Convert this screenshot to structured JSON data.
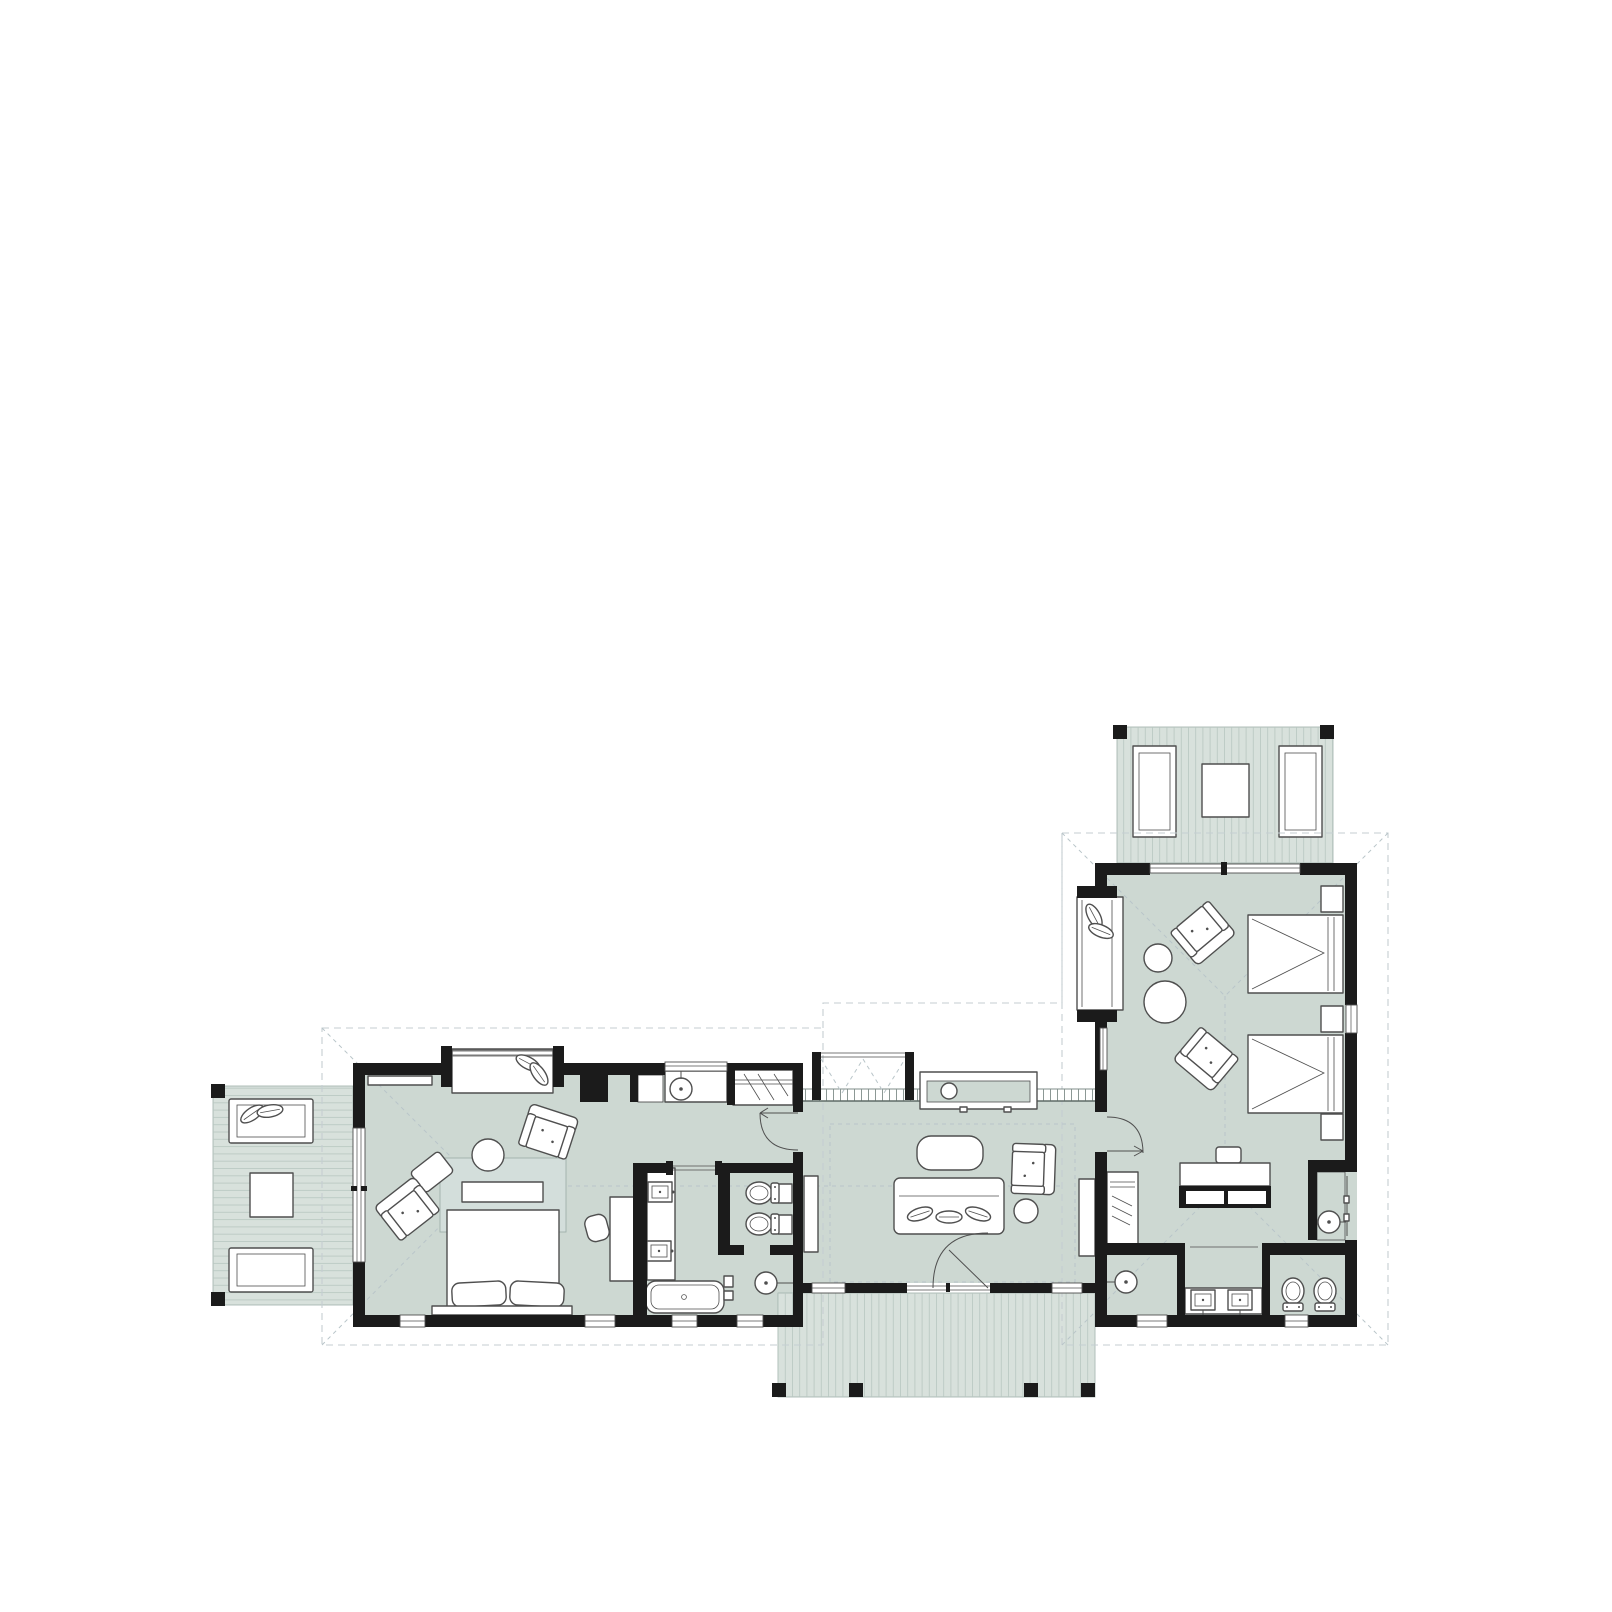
{
  "image": {
    "kind": "architectural floor plan, single-storey L-shaped house, top-down view",
    "width": 1612,
    "height": 1612,
    "background": "#ffffff",
    "visible_text": []
  },
  "palette": {
    "wall": "#1b1b1b",
    "floor": "#cdd8d2",
    "deck": "#d8e1dc",
    "deck_line": "#b7c6c0",
    "rug": "#d3dedb",
    "outline": "#4f4f4f",
    "light_line": "#9fb0aa",
    "dash": "#c5ced2",
    "dash2": "#b9c5c9",
    "rail": "#7f8d89",
    "white": "#ffffff"
  },
  "plan": {
    "decks": [
      "west-deck",
      "south-deck",
      "north-deck"
    ],
    "rooms": [
      "bedroom-west",
      "bath-corridor-west",
      "wc-room-west",
      "shower-room-west",
      "living-room",
      "bedroom-east",
      "shower-room-east",
      "vanity-room-east",
      "wc-room-east",
      "wash-room-east"
    ],
    "furniture": [
      "lounge-chair",
      "deck-table",
      "window-seat-bench",
      "wall-shelf",
      "double-bed",
      "foot-bench",
      "area-rug",
      "round-table",
      "armchair",
      "ottoman",
      "desk",
      "desk-chair",
      "sofa",
      "coffee-table",
      "side-table",
      "outdoor-counter",
      "twin-bed",
      "nightstand",
      "fireplace-unit",
      "wardrobe"
    ],
    "fixtures": [
      "round-washbasin",
      "double-vanity-sinks",
      "freestanding-bathtub",
      "toilet",
      "bidet",
      "rain-shower-head",
      "wash-stand"
    ],
    "doors": [
      "hinged-door-with-swing-arc",
      "pocket-door",
      "double-french-door",
      "bifold-door-bay"
    ],
    "roof": "dashed roof-overhang outlines with hip lines and ridges"
  }
}
